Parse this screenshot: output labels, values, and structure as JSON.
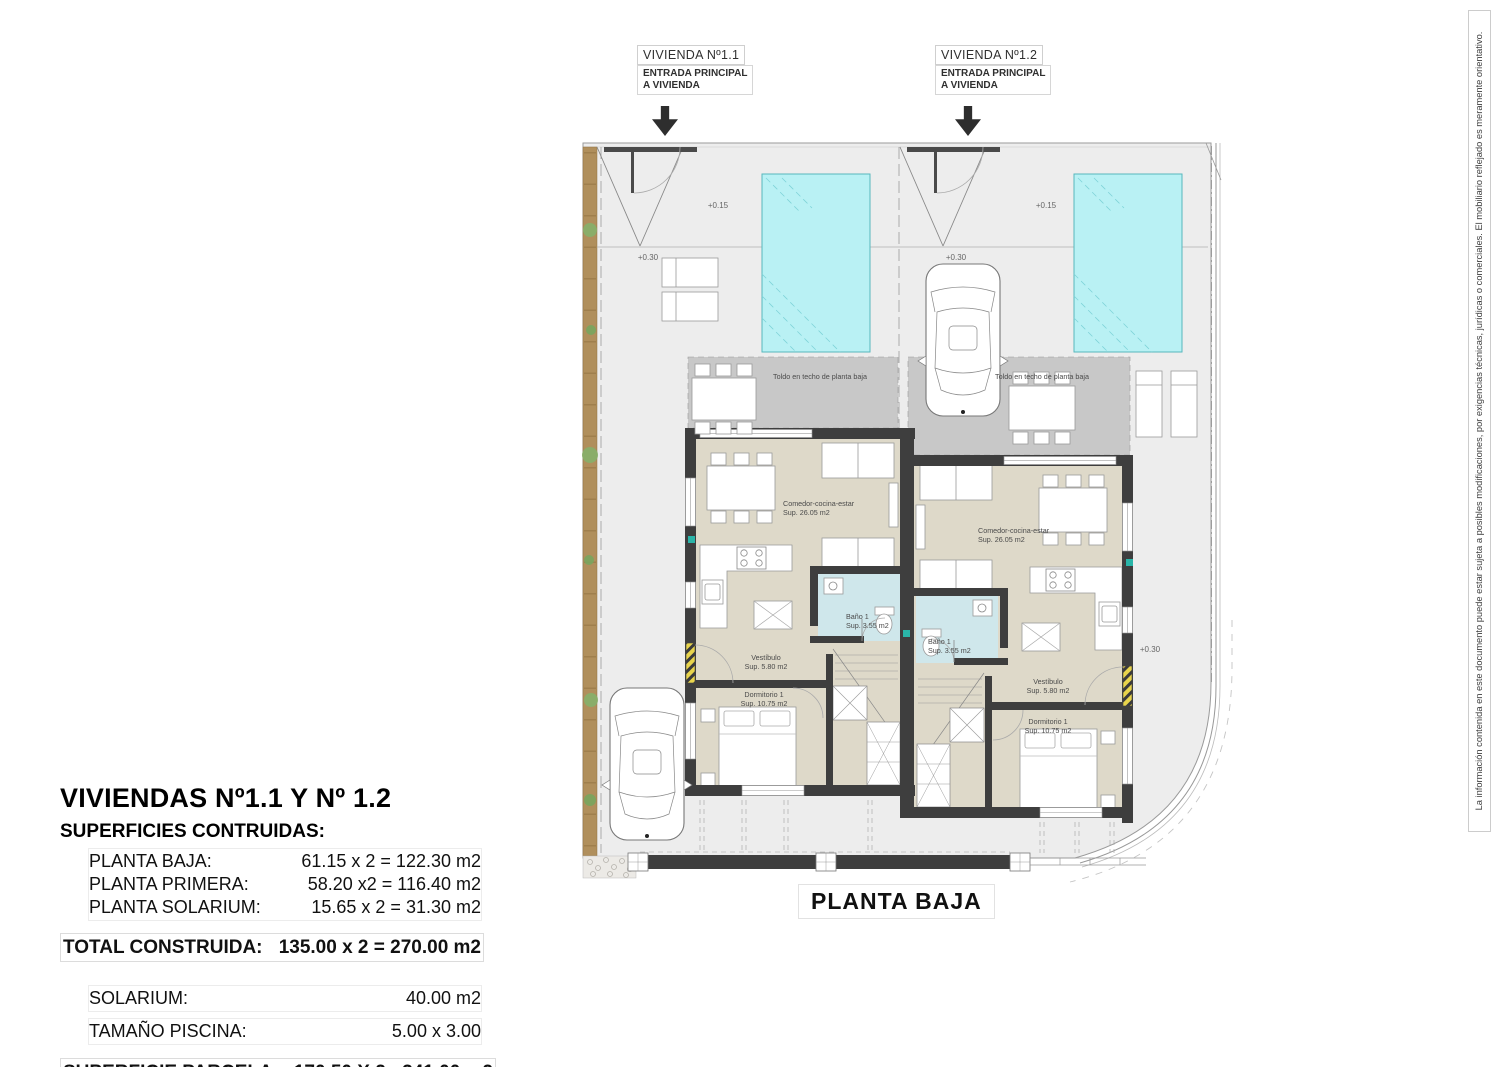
{
  "header": {
    "house1": {
      "title": "VIVIENDA Nº1.1",
      "entrance": [
        "ENTRADA PRINCIPAL",
        "A VIVIENDA"
      ]
    },
    "house2": {
      "title": "VIVIENDA Nº1.2",
      "entrance": [
        "ENTRADA PRINCIPAL",
        "A VIVIENDA"
      ]
    }
  },
  "plan": {
    "title": "PLANTA BAJA",
    "terrace_note": "Toldo en techo de planta baja",
    "levels": {
      "entry": "+0.15",
      "garden": "+0.30"
    },
    "rooms": {
      "living": {
        "name": "Comedor-cocina-estar",
        "area": "Sup. 26.05 m2"
      },
      "bath": {
        "name": "Baño 1",
        "area": "Sup. 3.55 m2"
      },
      "hall": {
        "name": "Vestíbulo",
        "area": "Sup. 5.80 m2"
      },
      "bedroom": {
        "name": "Dormitorio 1",
        "area": "Sup. 10.75 m2"
      }
    }
  },
  "summary": {
    "title": "VIVIENDAS Nº1.1 Y Nº 1.2",
    "subtitle": "SUPERFICIES CONTRUIDAS:",
    "rows": [
      {
        "label": "PLANTA BAJA:",
        "value": "61.15 x 2 = 122.30 m2"
      },
      {
        "label": "PLANTA PRIMERA:",
        "value": "58.20 x2 = 116.40 m2"
      },
      {
        "label": "PLANTA SOLARIUM:",
        "value": "15.65 x 2 = 31.30 m2"
      }
    ],
    "total": {
      "label": "TOTAL CONSTRUIDA:",
      "value": "135.00 x 2 = 270.00 m2"
    },
    "solarium": {
      "label": "SOLARIUM:",
      "value": "40.00 m2"
    },
    "pool_size": {
      "label": "TAMAÑO PISCINA:",
      "value": "5.00 x 3.00"
    },
    "parcel": {
      "label": "SUPERFICIE PARCELA:",
      "value": "170.50 X 2 =341.00 m2"
    }
  },
  "disclaimer": "La información contenida en este documento puede estar sujeta a posibles modificaciones, por exigencias técnicas, jurídicas o comerciales. El mobiliario reflejado es meramente orientativo.",
  "colors": {
    "parcel": "#ededed",
    "terrace": "#c8c8c8",
    "floor": "#ded9c9",
    "bath": "#cfe7eb",
    "wall": "#3e3e3e",
    "pool": "#b9f1f4",
    "vegetation": "#b08f5c",
    "door_accent": "#e8d44c"
  }
}
